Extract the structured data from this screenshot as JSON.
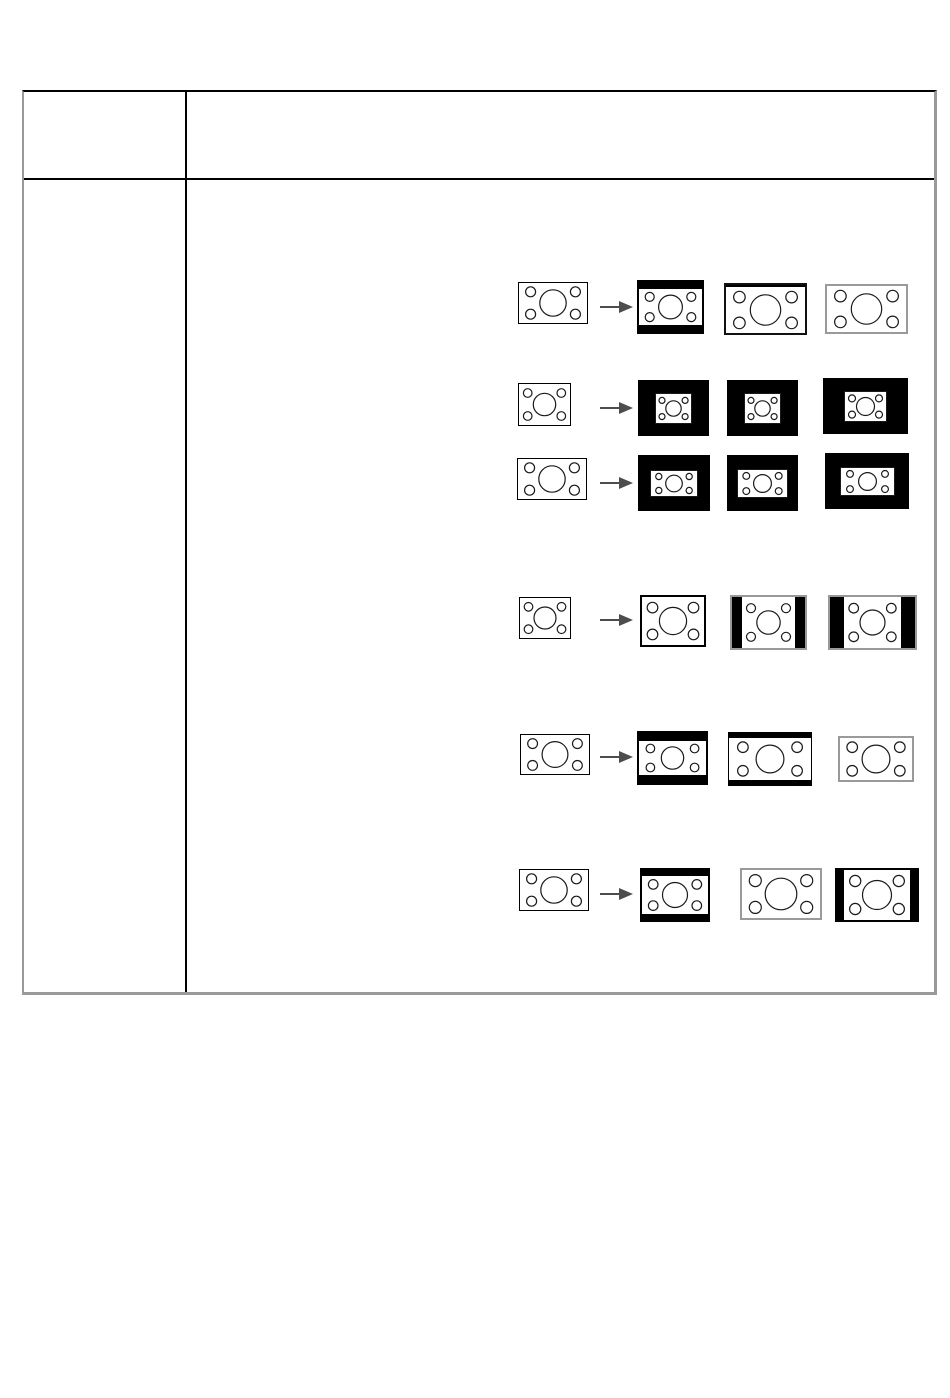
{
  "page": {
    "background": "#ffffff",
    "width": 950,
    "height": 1398
  },
  "table": {
    "x": 22,
    "y": 90,
    "width": 915,
    "height": 905,
    "left_column_width": 163,
    "header_row_height": 88,
    "border_top_color": "#000000",
    "border_side_color": "#9a9a9a",
    "grid_color": "#000000",
    "header_left_cell_text": "",
    "header_right_cell_text": "",
    "body_left_cell_text": "",
    "body_right_cell_text": ""
  },
  "diagram": {
    "description": "Six rows of screen-mode transformation diagrams: source test-pattern screen, arrow, three result screens (letterbox, pillarbox, windowed or full-screen variants)",
    "circle_stroke": "#1a1a1a",
    "arrow_color": "#4d4d4d",
    "black": "#000000",
    "rows": [
      {
        "source": {
          "x": 518,
          "y": 282,
          "w": 70,
          "h": 42,
          "border": "#000000",
          "bw": 1
        },
        "arrow": {
          "x": 600,
          "y": 307
        },
        "results": [
          {
            "x": 637,
            "y": 280,
            "w": 67,
            "h": 54,
            "border": "#000000",
            "bw": 2,
            "bars": [
              7,
              0,
              7,
              0
            ]
          },
          {
            "x": 724,
            "y": 283,
            "w": 83,
            "h": 52,
            "border": "#111111",
            "bw": 2,
            "bars": [
              2,
              0,
              0,
              0
            ]
          },
          {
            "x": 825,
            "y": 284,
            "w": 83,
            "h": 50,
            "border": "#9a9a9a",
            "bw": 2
          }
        ]
      },
      {
        "source": {
          "x": 518,
          "y": 383,
          "w": 53,
          "h": 43,
          "border": "#000000",
          "bw": 1
        },
        "arrow": {
          "x": 600,
          "y": 408
        },
        "results": [
          {
            "x": 638,
            "y": 380,
            "w": 71,
            "h": 56,
            "border": "#000000",
            "bw": 1,
            "window": [
              37,
              31
            ]
          },
          {
            "x": 727,
            "y": 380,
            "w": 71,
            "h": 56,
            "border": "#000000",
            "bw": 1,
            "window": [
              37,
              31
            ]
          },
          {
            "x": 823,
            "y": 378,
            "w": 85,
            "h": 56,
            "border": "#000000",
            "bw": 1,
            "window": [
              43,
              31
            ]
          }
        ]
      },
      {
        "source": {
          "x": 517,
          "y": 458,
          "w": 70,
          "h": 42,
          "border": "#000000",
          "bw": 1
        },
        "arrow": {
          "x": 600,
          "y": 483
        },
        "results": [
          {
            "x": 638,
            "y": 455,
            "w": 72,
            "h": 56,
            "border": "#000000",
            "bw": 1,
            "window": [
              48,
              27
            ]
          },
          {
            "x": 727,
            "y": 455,
            "w": 71,
            "h": 56,
            "border": "#000000",
            "bw": 1,
            "window": [
              51,
              29
            ]
          },
          {
            "x": 825,
            "y": 453,
            "w": 84,
            "h": 56,
            "border": "#000000",
            "bw": 1,
            "window": [
              55,
              29
            ]
          }
        ]
      },
      {
        "source": {
          "x": 519,
          "y": 597,
          "w": 52,
          "h": 42,
          "border": "#000000",
          "bw": 1
        },
        "arrow": {
          "x": 600,
          "y": 620
        },
        "results": [
          {
            "x": 640,
            "y": 595,
            "w": 66,
            "h": 52,
            "border": "#000000",
            "bw": 2
          },
          {
            "x": 730,
            "y": 595,
            "w": 77,
            "h": 55,
            "border": "#999999",
            "bw": 2,
            "bars": [
              0,
              10,
              0,
              10
            ]
          },
          {
            "x": 828,
            "y": 595,
            "w": 89,
            "h": 55,
            "border": "#999999",
            "bw": 2,
            "bars": [
              0,
              14,
              0,
              14
            ]
          }
        ]
      },
      {
        "source": {
          "x": 520,
          "y": 734,
          "w": 70,
          "h": 41,
          "border": "#000000",
          "bw": 1
        },
        "arrow": {
          "x": 600,
          "y": 757
        },
        "results": [
          {
            "x": 637,
            "y": 731,
            "w": 71,
            "h": 54,
            "border": "#000000",
            "bw": 2,
            "bars": [
              8,
              0,
              8,
              0
            ]
          },
          {
            "x": 728,
            "y": 732,
            "w": 84,
            "h": 54,
            "border": "#000000",
            "bw": 1,
            "bars": [
              5,
              0,
              5,
              0
            ]
          },
          {
            "x": 838,
            "y": 736,
            "w": 76,
            "h": 46,
            "border": "#9a9a9a",
            "bw": 2
          }
        ]
      },
      {
        "source": {
          "x": 519,
          "y": 869,
          "w": 70,
          "h": 42,
          "border": "#000000",
          "bw": 1
        },
        "arrow": {
          "x": 600,
          "y": 894
        },
        "results": [
          {
            "x": 640,
            "y": 868,
            "w": 70,
            "h": 54,
            "border": "#000000",
            "bw": 2,
            "bars": [
              6,
              0,
              6,
              0
            ]
          },
          {
            "x": 740,
            "y": 868,
            "w": 82,
            "h": 52,
            "border": "#9a9a9a",
            "bw": 2
          },
          {
            "x": 835,
            "y": 868,
            "w": 84,
            "h": 54,
            "border": "#000000",
            "bw": 2,
            "bars": [
              0,
              7,
              0,
              7
            ]
          }
        ]
      }
    ]
  }
}
